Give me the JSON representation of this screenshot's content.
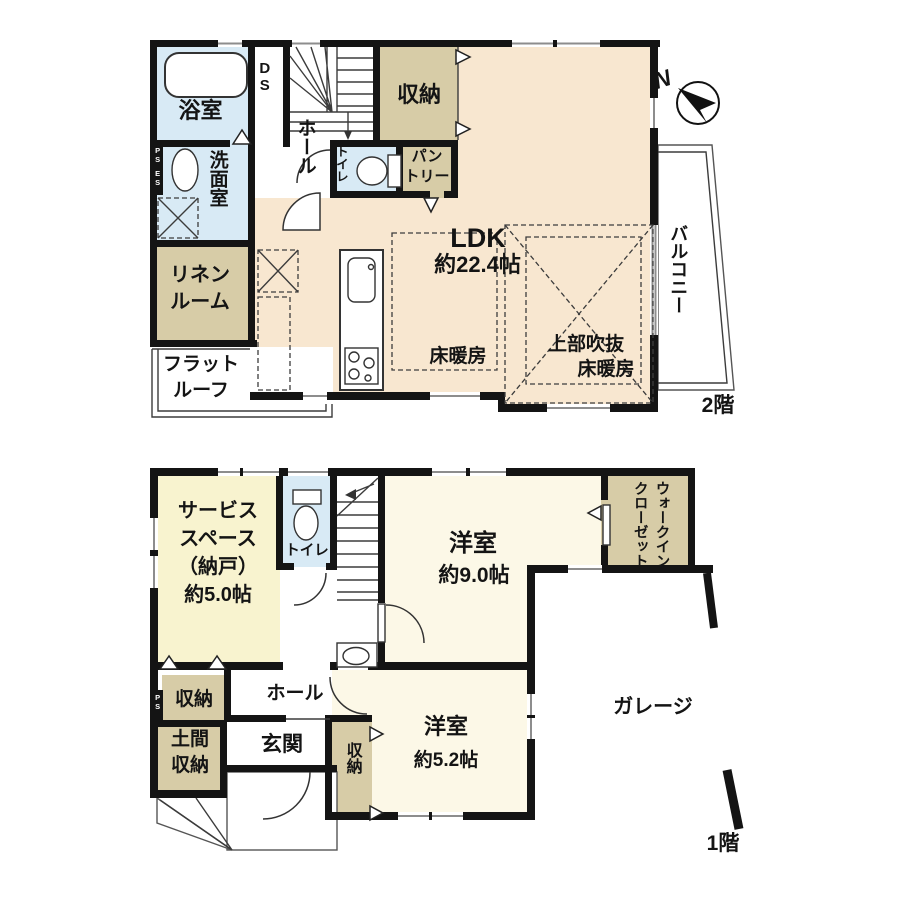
{
  "palette": {
    "wall": "#141414",
    "ldk_floor": "#f8e7d0",
    "storage_tan": "#d7cca7",
    "wet_area_blue": "#d8eaf5",
    "bedroom_cream": "#fcf8e7",
    "service_yellow": "#f8f3cf"
  },
  "floor2": {
    "floor_label": "2階",
    "bath": "浴室",
    "duct_space": "DS",
    "hall": "ホール",
    "storage": "収納",
    "toilet": "トイレ",
    "pantry": "パン\nトリー",
    "washroom": "洗面室",
    "linen_room": "リネン\nルーム",
    "flat_roof": "フラット\nルーフ",
    "ldk_name": "LDK",
    "ldk_size": "約22.4帖",
    "floor_heating_left": "床暖房",
    "void_above": "上部吹抜",
    "floor_heating_right": "床暖房",
    "balcony": "バルコニー",
    "pipe_space": "PS",
    "electric_space": "ES",
    "compass_north": "N"
  },
  "floor1": {
    "floor_label": "1階",
    "service_space": "サービス\nスペース\n（納戸）\n約5.0帖",
    "toilet": "トイレ",
    "walk_in_closet": "ウォークイン\nクローゼット",
    "bedroom_9_name": "洋室",
    "bedroom_9_size": "約9.0帖",
    "hall": "ホール",
    "hall_storage": "収納",
    "doma_storage": "土間\n収納",
    "entrance": "玄関",
    "bedroom_5_storage": "収納",
    "bedroom_5_name": "洋室",
    "bedroom_5_size": "約5.2帖",
    "garage": "ガレージ",
    "pipe_space": "PS"
  }
}
